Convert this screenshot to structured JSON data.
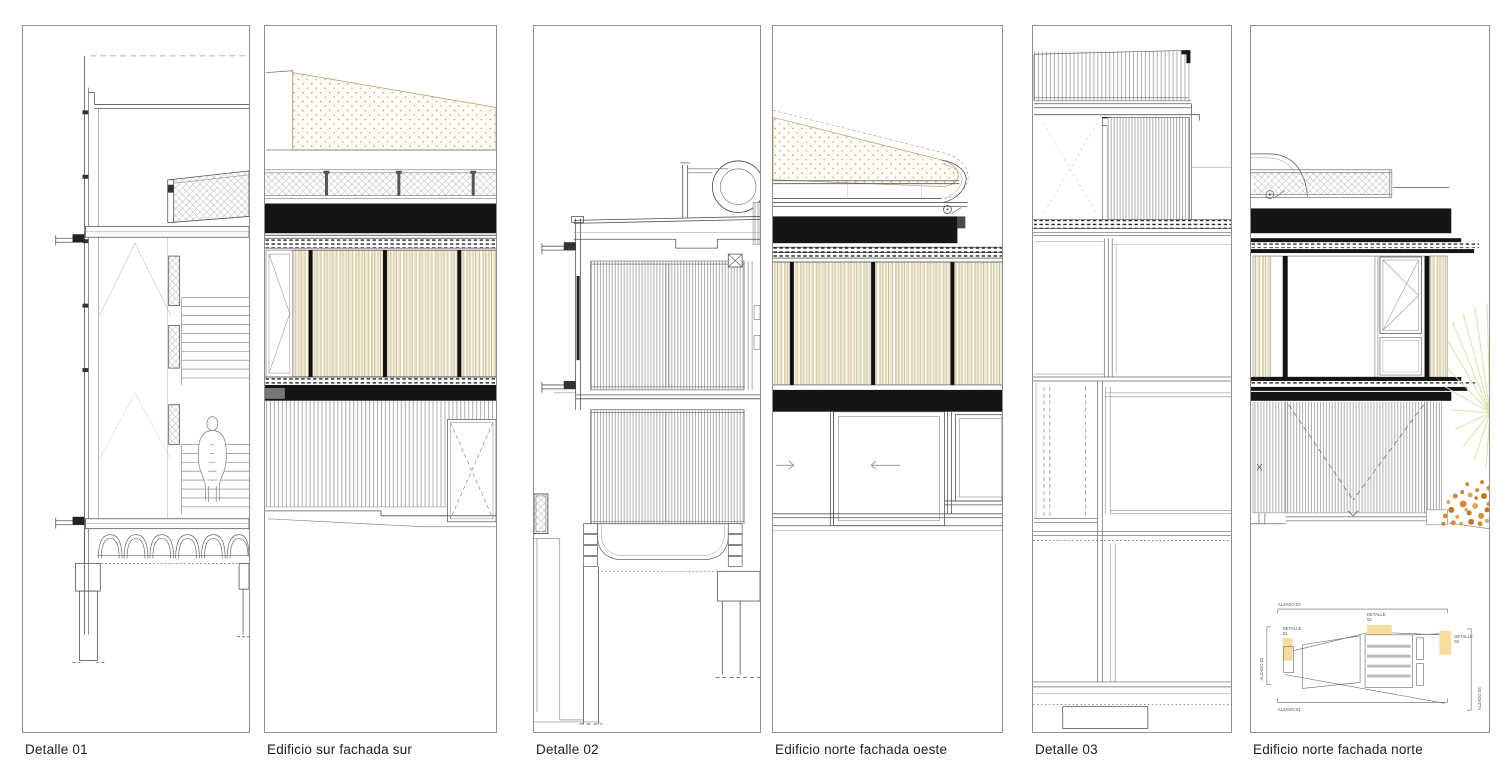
{
  "sheet": {
    "background": "#ffffff"
  },
  "panels": [
    {
      "caption": "Detalle 01"
    },
    {
      "caption": "Edificio sur fachada sur"
    },
    {
      "caption": "Detalle 02"
    },
    {
      "caption": "Edificio norte fachada oeste"
    },
    {
      "caption": "Detalle 03"
    },
    {
      "caption": "Edificio norte fachada norte",
      "keyplan": {
        "alzado_top": "ALZADO 02",
        "alzado_bottom": "ALZADO 01",
        "alzado_left": "ALZADO 03",
        "alzado_right": "ALZADO 04",
        "detalles": [
          {
            "word": "DETALLE",
            "num": "01"
          },
          {
            "word": "DETALLE",
            "num": "02"
          },
          {
            "word": "DETALLE",
            "num": "03"
          }
        ]
      }
    }
  ],
  "colors": {
    "panel_border": "#8f8f8f",
    "caption_text": "#1f1f1f",
    "line": "#555555",
    "black_band": "#151515",
    "slat_tan": "#ded3b0",
    "slat_cream": "#f7f4ea",
    "stipple_dot": "#c29d5f",
    "keyplan_highlight": "#f5d78e",
    "plant_green": "#d6e2a6",
    "flower_orange": "#d98b3c"
  }
}
